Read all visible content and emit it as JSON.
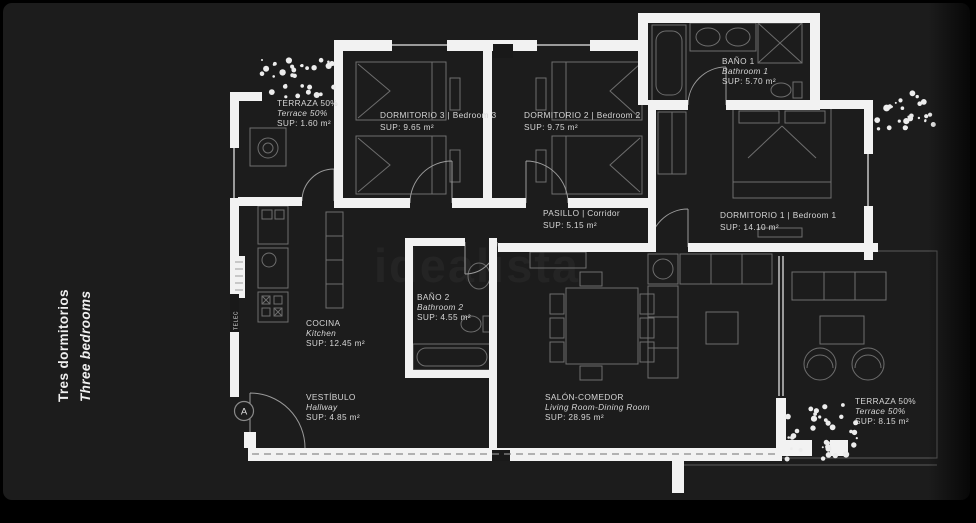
{
  "meta": {
    "title_es": "Tres dormitorios",
    "title_en": "Three bedrooms"
  },
  "watermark": "idealista",
  "entrance": {
    "label": "A"
  },
  "utility": {
    "label": "TELEC"
  },
  "colors": {
    "background": "#1c1c1c",
    "frame": "#000000",
    "wall": "#f2f2f2",
    "furniture_line": "#6e6e6e",
    "window_line": "#9a9a9a",
    "label_text": "#d6d6d6",
    "watermark": "#242424",
    "vegetation": "#ececec"
  },
  "rooms": [
    {
      "id": "terraza-top-left",
      "lines": [
        "TERRAZA 50%",
        "Terrace 50%",
        "SUP: 1.60 m²"
      ]
    },
    {
      "id": "dormitorio-3",
      "lines": [
        "DORMITORIO 3 | Bedroom 3",
        "SUP: 9.65 m²"
      ]
    },
    {
      "id": "dormitorio-2",
      "lines": [
        "DORMITORIO 2 | Bedroom 2",
        "SUP: 9.75 m²"
      ]
    },
    {
      "id": "bano-1",
      "lines": [
        "BAÑO 1",
        "Bathroom 1",
        "SUP: 5.70 m²"
      ]
    },
    {
      "id": "pasillo",
      "lines": [
        "PASILLO | Corridor",
        "SUP: 5.15 m²"
      ]
    },
    {
      "id": "dormitorio-1",
      "lines": [
        "DORMITORIO 1 | Bedroom 1",
        "SUP: 14.10 m²"
      ]
    },
    {
      "id": "cocina",
      "lines": [
        "COCINA",
        "Kitchen",
        "SUP: 12.45 m²"
      ]
    },
    {
      "id": "bano-2",
      "lines": [
        "BAÑO 2",
        "Bathroom 2",
        "SUP: 4.55 m²"
      ]
    },
    {
      "id": "salon-comedor",
      "lines": [
        "SALÓN-COMEDOR",
        "Living Room-Dining Room",
        "SUP: 28.95 m²"
      ]
    },
    {
      "id": "vestibulo",
      "lines": [
        "VESTÍBULO",
        "Hallway",
        "SUP: 4.85 m²"
      ]
    },
    {
      "id": "terraza-bottom-right",
      "lines": [
        "TERRAZA 50%",
        "Terrace 50%",
        "SUP: 8.15 m²"
      ]
    }
  ]
}
